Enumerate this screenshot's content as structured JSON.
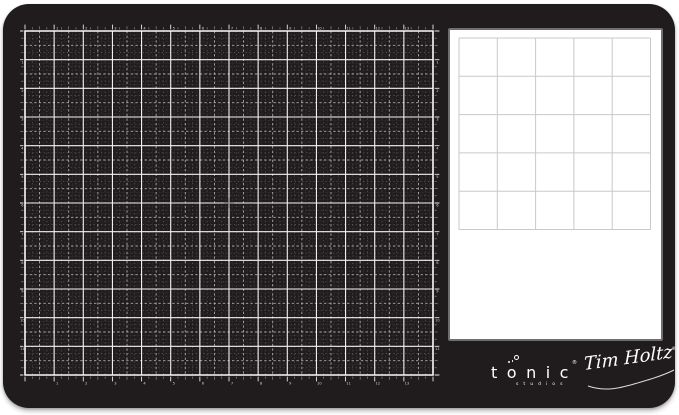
{
  "image": {
    "background": "#ffffff"
  },
  "mat": {
    "color": "#201c1d",
    "corner_radius_px": 26
  },
  "cutting_grid": {
    "columns": 14,
    "rows": 12,
    "line_color": "#ffffff",
    "fine_subdivisions_per_unit": 8,
    "has_ruler_ticks": true,
    "has_edge_numbers": true,
    "center_mark_color": "#909090"
  },
  "panel": {
    "background": "#ffffff",
    "border_color": "#6f6f6f",
    "grid": {
      "columns": 5,
      "rows": 5,
      "cell_px": 38.3,
      "line_color": "#c9c9c9"
    }
  },
  "branding": {
    "tonic_letters": [
      "t",
      "o",
      "n",
      "i",
      "c"
    ],
    "studios": "studios",
    "signature": "Tim Holtz",
    "registered": "®",
    "text_color": "#ffffff"
  }
}
